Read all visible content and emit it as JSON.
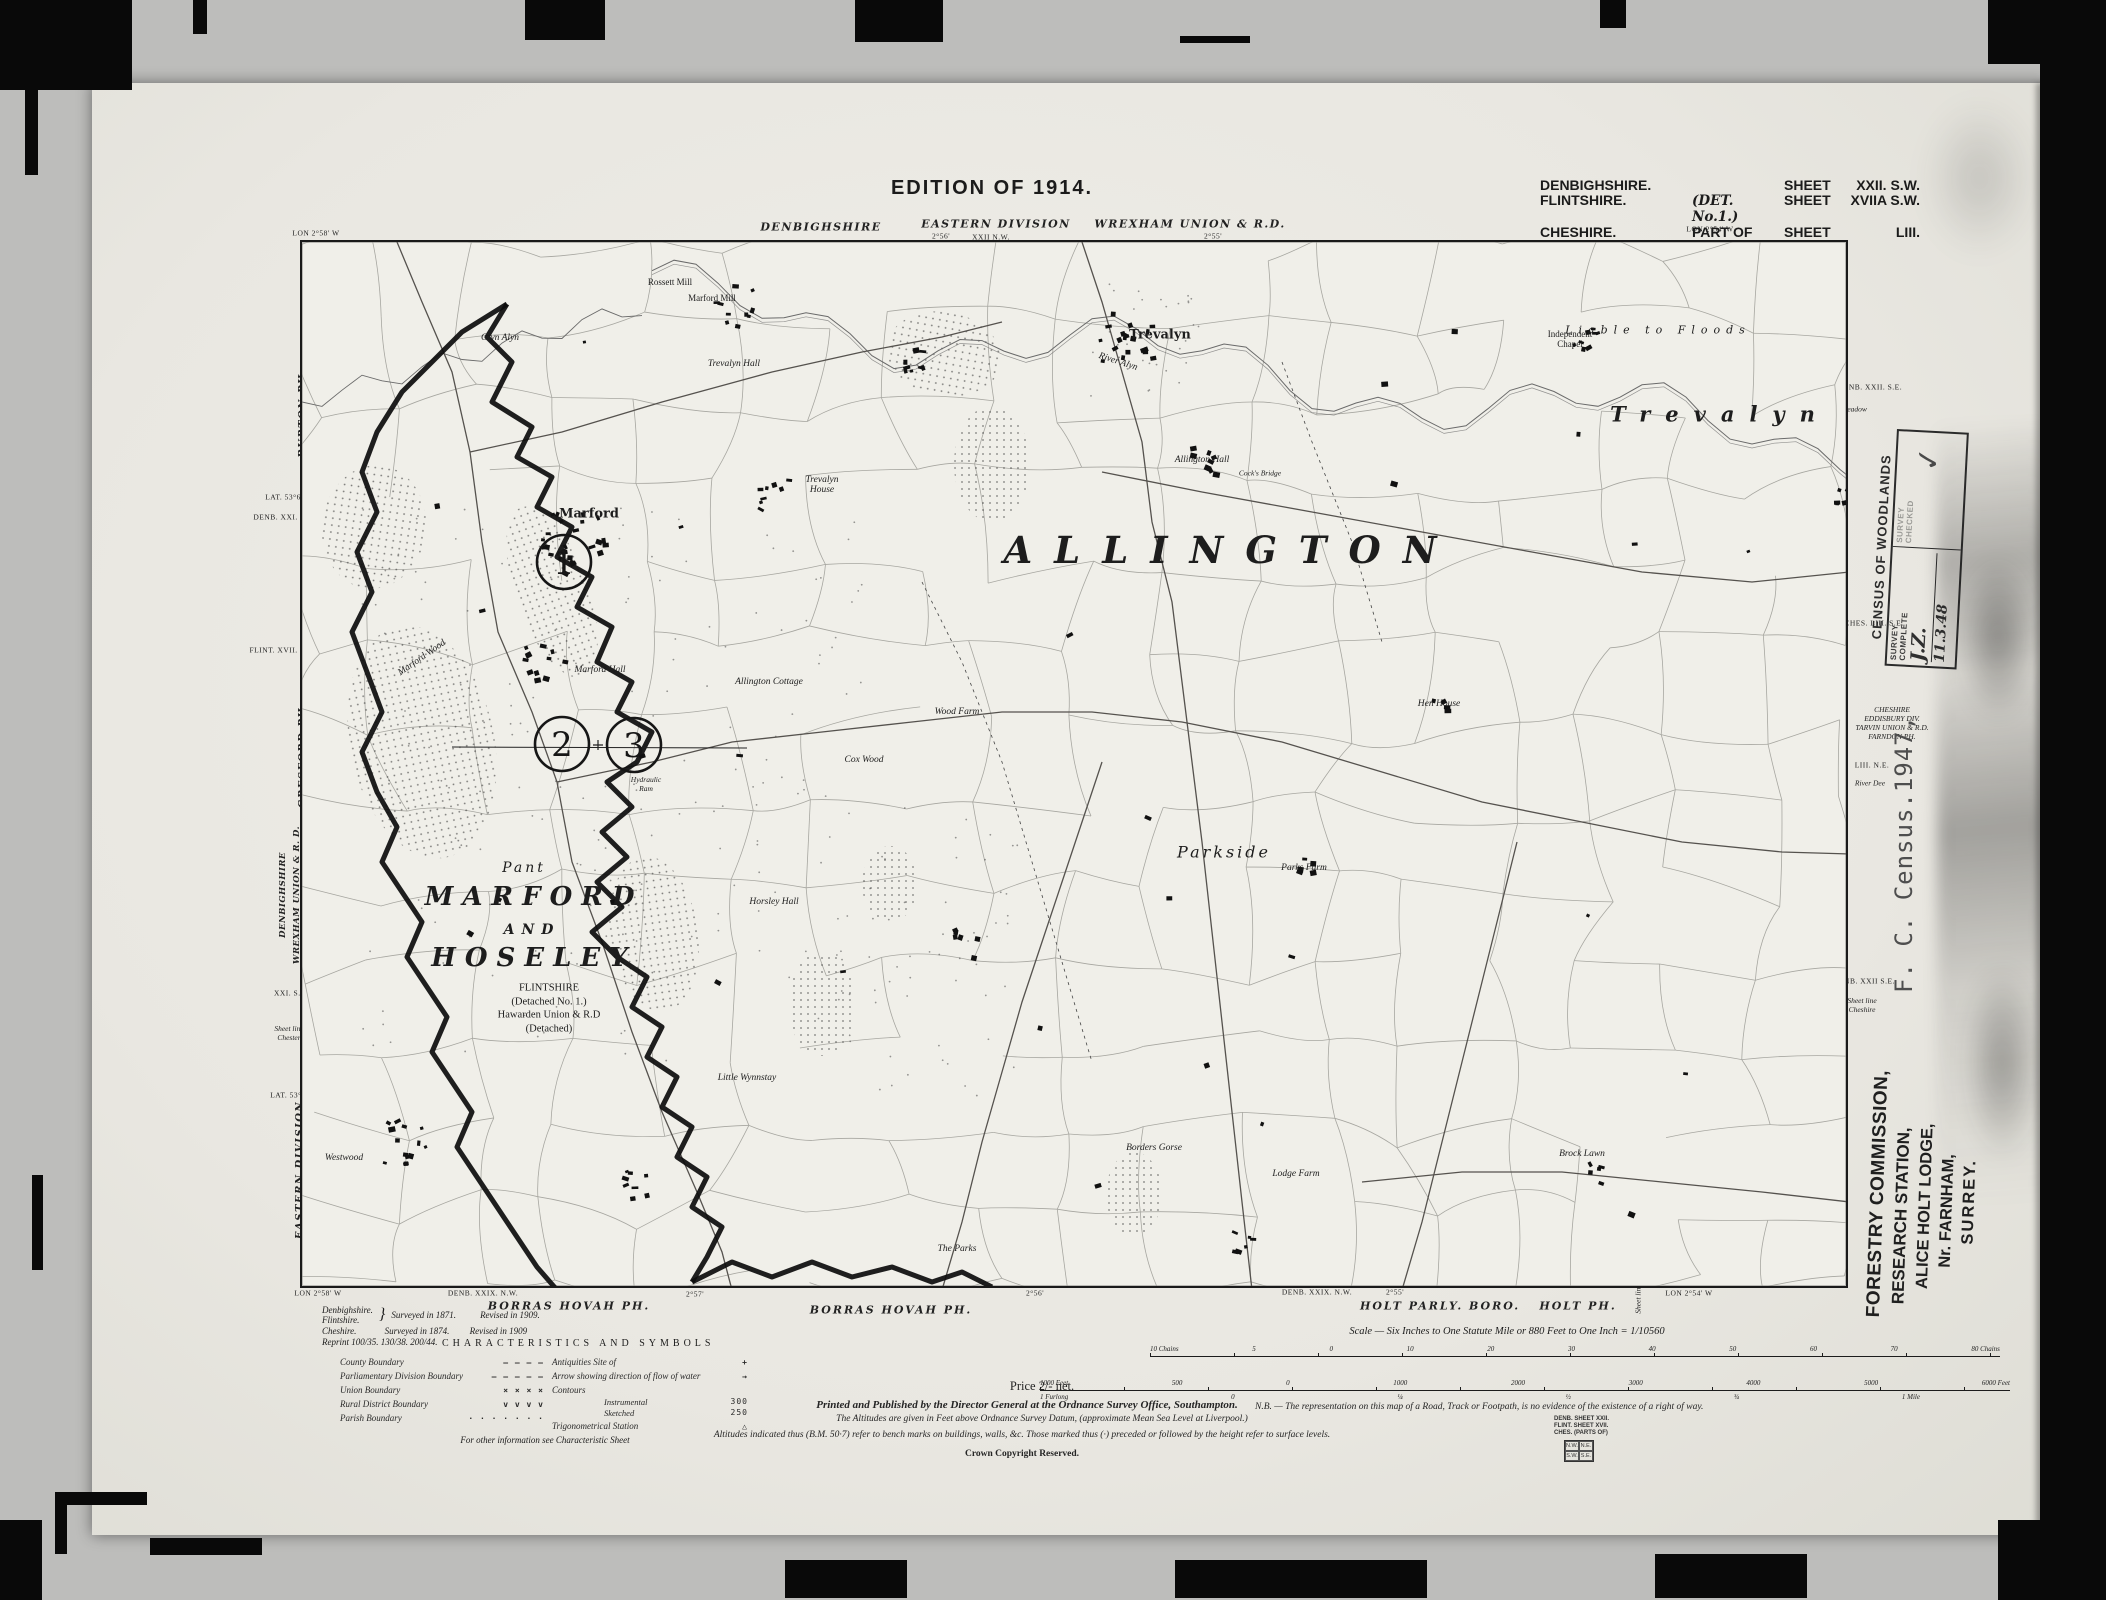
{
  "edition": "EDITION OF 1914.",
  "sheet_info": {
    "rows": [
      {
        "county": "DENBIGHSHIRE.",
        "detail": "",
        "sheet": "SHEET",
        "number": "XXII. S.W."
      },
      {
        "county": "FLINTSHIRE.",
        "detail": "(DET. No.1.)",
        "sheet": "SHEET",
        "number": "XVIIA S.W."
      },
      {
        "county": "CHESHIRE.",
        "detail": "PART OF",
        "sheet": "SHEET",
        "number": "LIII."
      }
    ]
  },
  "top_margin": {
    "items": [
      {
        "text": "LON 2°58' W",
        "x": 224,
        "y": 150,
        "cls": "t6"
      },
      {
        "text": "DENBIGHSHIRE",
        "x": 729,
        "y": 144,
        "cls": "county"
      },
      {
        "text": "EASTERN DIVISION",
        "x": 904,
        "y": 141,
        "cls": "county"
      },
      {
        "text": "2°56'",
        "x": 849,
        "y": 153,
        "cls": "t6"
      },
      {
        "text": "XXII N.W.",
        "x": 899,
        "y": 154,
        "cls": "t6"
      },
      {
        "text": "WREXHAM UNION & R.D.",
        "x": 1098,
        "y": 141,
        "cls": "county"
      },
      {
        "text": "2°55'",
        "x": 1121,
        "y": 153,
        "cls": "t6"
      },
      {
        "text": "LON 2°54' W",
        "x": 1618,
        "y": 146,
        "cls": "t6"
      }
    ]
  },
  "left_margin": {
    "items": [
      {
        "text": "BURTON PH.",
        "x": 211,
        "y": 330,
        "cls": "ph",
        "rot": true
      },
      {
        "text": "LAT. 53°6'",
        "x": 192,
        "y": 414,
        "cls": "t6"
      },
      {
        "text": "DENB. XXI. S.E.",
        "x": 192,
        "y": 434,
        "cls": "t6"
      },
      {
        "text": "FLINT. XVII. S.E.",
        "x": 190,
        "y": 567,
        "cls": "t6"
      },
      {
        "text": "GRESFORD PH.",
        "x": 211,
        "y": 672,
        "cls": "ph",
        "rot": true
      },
      {
        "text": "DENBIGHSHIRE",
        "x": 191,
        "y": 812,
        "cls": "ph2",
        "rot": true
      },
      {
        "text": "WREXHAM UNION & R. D.",
        "x": 205,
        "y": 812,
        "cls": "ph2",
        "rot": true
      },
      {
        "text": "Gresford",
        "x": 216,
        "y": 883,
        "cls": "t6i",
        "rot": true
      },
      {
        "text": "XXI. S.E.",
        "x": 199,
        "y": 910,
        "cls": "t6"
      },
      {
        "text": "Sheet line\nChester",
        "x": 197,
        "y": 950,
        "cls": "t6i"
      },
      {
        "text": "LAT. 53°5'",
        "x": 197,
        "y": 1012,
        "cls": "t6"
      },
      {
        "text": "EASTERN DIVISION",
        "x": 208,
        "y": 1087,
        "cls": "ph",
        "rot": true
      }
    ]
  },
  "right_margin": {
    "items": [
      {
        "text": "DENB. XXII. S.E.",
        "x": 1778,
        "y": 304,
        "cls": "t6"
      },
      {
        "text": "Meadow",
        "x": 1762,
        "y": 326,
        "cls": "t6i"
      },
      {
        "text": "CHES. LIII. S.E.",
        "x": 1782,
        "y": 540,
        "cls": "t6"
      },
      {
        "text": "CHESHIRE\nEDDISBURY DIV.\nTARVIN UNION & R.D.\nFARNDON PH.",
        "x": 1800,
        "y": 640,
        "cls": "t6i"
      },
      {
        "text": "LIII. N.E.",
        "x": 1780,
        "y": 682,
        "cls": "t6"
      },
      {
        "text": "River Dee",
        "x": 1778,
        "y": 700,
        "cls": "t6i"
      },
      {
        "text": "DENB. XXII S.E.",
        "x": 1772,
        "y": 898,
        "cls": "t6"
      },
      {
        "text": "Sheet line\nCheshire",
        "x": 1770,
        "y": 922,
        "cls": "t6i"
      }
    ]
  },
  "bottom_margin": {
    "items": [
      {
        "text": "LON 2°58' W",
        "x": 226,
        "y": 1210,
        "cls": "t6"
      },
      {
        "text": "DENB. XXIX. N.W.",
        "x": 391,
        "y": 1210,
        "cls": "t6"
      },
      {
        "text": "BORRAS HOVAH PH.",
        "x": 477,
        "y": 1223,
        "cls": "phh"
      },
      {
        "text": "2°57'",
        "x": 603,
        "y": 1211,
        "cls": "t6"
      },
      {
        "text": "BORRAS HOVAH PH.",
        "x": 799,
        "y": 1227,
        "cls": "phh"
      },
      {
        "text": "2°56'",
        "x": 943,
        "y": 1210,
        "cls": "t6"
      },
      {
        "text": "DENB. XXIX. N.W.",
        "x": 1225,
        "y": 1209,
        "cls": "t6"
      },
      {
        "text": "2°55'",
        "x": 1303,
        "y": 1209,
        "cls": "t6"
      },
      {
        "text": "HOLT PARLY. BORO.",
        "x": 1348,
        "y": 1223,
        "cls": "phh"
      },
      {
        "text": "HOLT PH.",
        "x": 1486,
        "y": 1223,
        "cls": "phh"
      },
      {
        "text": "Sheet line",
        "x": 1546,
        "y": 1216,
        "cls": "t6i",
        "rot": true
      },
      {
        "text": "LON 2°54' W",
        "x": 1597,
        "y": 1210,
        "cls": "t6"
      }
    ]
  },
  "survey_notes": {
    "brace_counties": "Denbighshire.\nFlintshire.",
    "brace": "}",
    "brace_surveyed": "Surveyed in 1871.",
    "brace_revised": "Revised in 1909.",
    "line2_county": "Cheshire.",
    "line2_surveyed": "Surveyed in 1874.",
    "line2_revised": "Revised in 1909",
    "reprint": "Reprint 100/35. 130/38. 200/44."
  },
  "legend": {
    "title": "CHARACTERISTICS AND SYMBOLS",
    "left": [
      {
        "label": "County Boundary",
        "glyph": "— — — —"
      },
      {
        "label": "Parliamentary Division Boundary",
        "glyph": "– – – – –"
      },
      {
        "label": "Union Boundary",
        "glyph": "×  ×  ×  ×"
      },
      {
        "label": "Rural District Boundary",
        "glyph": "v  v  v  v"
      },
      {
        "label": "Parish Boundary",
        "glyph": "· · · · · · ·"
      }
    ],
    "right": [
      {
        "label": "Antiquities  Site of",
        "glyph": "+"
      },
      {
        "label": "Arrow showing direction of flow of water",
        "glyph": "→"
      },
      {
        "label": "Contours",
        "sub": [
          {
            "label": "Instrumental",
            "glyph": "300"
          },
          {
            "label": "Sketched",
            "glyph": "250"
          }
        ]
      },
      {
        "label": "Trigonometrical Station",
        "glyph": "△"
      }
    ],
    "footnote": "For other information see Characteristic Sheet"
  },
  "scale_block": {
    "title": "Scale — Six Inches to One Statute Mile or 880 Feet to One Inch = 1/10560",
    "chains_labels": [
      "10 Chains",
      "5",
      "0",
      "10",
      "20",
      "30",
      "40",
      "50",
      "60",
      "70",
      "80 Chains"
    ],
    "feet_labels": [
      "1000 Feet",
      "500",
      "0",
      "1000",
      "2000",
      "3000",
      "4000",
      "5000",
      "6000 Feet"
    ],
    "mile_labels": [
      "1 Furlong",
      "0",
      "¼",
      "½",
      "¾",
      "1 Mile"
    ]
  },
  "footer": {
    "price": "Price 2/- net.",
    "publisher": "Printed and Published by the Director General at the Ordnance Survey Office, Southampton.",
    "nb": "N.B. — The representation on this map of a Road, Track or Footpath, is no evidence of the existence of a right of way.",
    "altitude1": "The Altitudes are given in Feet above Ordnance Survey Datum, (approximate Mean Sea Level at Liverpool.)",
    "altitude2": "Altitudes indicated thus (B.M. 50·7) refer to bench marks on buildings, walls, &c. Those marked thus (·) preceded or followed by the height refer to surface levels.",
    "copyright": "Crown Copyright Reserved.",
    "index_lines": "DENB. SHEET XXII.\nFLINT. SHEET XVII.\nCHES. (PARTS OF)",
    "index_grid": [
      "N.W.",
      "N.E.",
      "S.W.",
      "S.E."
    ]
  },
  "stamps": {
    "census_title": "CENSUS OF WOODLANDS",
    "census_cells": {
      "c1_label": "SURVEY\nCOMPLETE",
      "c1_hand": "J.Z.",
      "c1_date": "11.3.48",
      "c2_label": "SURVEY\nCHECKED",
      "c2_mark": "✓"
    },
    "census_ref": "F. C. Census.1947,",
    "forestry": [
      "FORESTRY COMMISSION,",
      "RESEARCH STATION,",
      "ALICE HOLT LODGE,",
      "Nr. FARNHAM,",
      "SURREY."
    ]
  },
  "map": {
    "circles": [
      {
        "n": "1",
        "x": 262,
        "y": 320
      },
      {
        "n": "2",
        "x": 260,
        "y": 502
      },
      {
        "n": "3",
        "x": 332,
        "y": 503
      }
    ],
    "labels": [
      {
        "text": "ALLINGTON",
        "x": 929,
        "y": 308,
        "cls": "lh"
      },
      {
        "text": "MARFORD",
        "x": 232,
        "y": 655,
        "cls": "lb"
      },
      {
        "text": "AND",
        "x": 230,
        "y": 688,
        "cls": "lmsp"
      },
      {
        "text": "HOSELEY",
        "x": 232,
        "y": 716,
        "cls": "lb"
      },
      {
        "text": "Trevalyn",
        "x": 1418,
        "y": 172,
        "cls": "llg"
      },
      {
        "text": "Liable to Floods",
        "x": 1356,
        "y": 88,
        "cls": "lsp"
      },
      {
        "text": "Parkside",
        "x": 922,
        "y": 610,
        "cls": "lmd"
      },
      {
        "text": "Pant",
        "x": 222,
        "y": 626,
        "cls": "lmd2"
      },
      {
        "text": "Trevalyn",
        "x": 858,
        "y": 93,
        "cls": "lbold"
      },
      {
        "text": "Marford",
        "x": 287,
        "y": 272,
        "cls": "lbold"
      },
      {
        "text": "FLINTSHIRE\n(Detached No. 1.)\nHawarden Union & R.D\n(Detached)",
        "x": 247,
        "y": 767,
        "cls": "lnote"
      },
      {
        "text": "Trevalyn\nHouse",
        "x": 520,
        "y": 243,
        "cls": "lsmi"
      },
      {
        "text": "Allington Hall",
        "x": 900,
        "y": 218,
        "cls": "lsmi"
      },
      {
        "text": "Independent\nChapel",
        "x": 1268,
        "y": 97,
        "cls": "lsm"
      },
      {
        "text": "Allington Cottage",
        "x": 467,
        "y": 440,
        "cls": "lsmi"
      },
      {
        "text": "Horsley Hall",
        "x": 472,
        "y": 660,
        "cls": "lsmi"
      },
      {
        "text": "Little Wynnstay",
        "x": 445,
        "y": 836,
        "cls": "lsmi"
      },
      {
        "text": "Borders Gorse",
        "x": 852,
        "y": 906,
        "cls": "lsmi"
      },
      {
        "text": "Lodge Farm",
        "x": 994,
        "y": 932,
        "cls": "lsmi"
      },
      {
        "text": "The Parks",
        "x": 655,
        "y": 1007,
        "cls": "lsmi"
      },
      {
        "text": "Brock Lawn",
        "x": 1280,
        "y": 912,
        "cls": "lsmi"
      },
      {
        "text": "Parks Farm",
        "x": 1002,
        "y": 626,
        "cls": "lsmi"
      },
      {
        "text": "Wood Farm",
        "x": 655,
        "y": 470,
        "cls": "lsmi"
      },
      {
        "text": "Cox Wood",
        "x": 562,
        "y": 518,
        "cls": "lsmi"
      },
      {
        "text": "Marford Hall",
        "x": 298,
        "y": 428,
        "cls": "lsmi"
      },
      {
        "text": "Marford Mill",
        "x": 410,
        "y": 56,
        "cls": "lsm"
      },
      {
        "text": "Rossett Mill",
        "x": 368,
        "y": 40,
        "cls": "lsm"
      },
      {
        "text": "Glyn Alyn",
        "x": 198,
        "y": 96,
        "cls": "lsmi"
      },
      {
        "text": "Trevalyn Hall",
        "x": 432,
        "y": 122,
        "cls": "lsmi"
      },
      {
        "text": "Marford Wood",
        "x": 120,
        "y": 416,
        "cls": "lsmi",
        "rot": -35
      },
      {
        "text": "Westwood",
        "x": 42,
        "y": 916,
        "cls": "lsmi"
      },
      {
        "text": "River Alyn",
        "x": 816,
        "y": 120,
        "cls": "lsmi",
        "rot": 18
      },
      {
        "text": "Hydraulic\nRam",
        "x": 344,
        "y": 542,
        "cls": "ltiny"
      },
      {
        "text": "Cock's Bridge",
        "x": 958,
        "y": 231,
        "cls": "ltiny"
      },
      {
        "text": "Hen House",
        "x": 1137,
        "y": 462,
        "cls": "lsmi"
      }
    ]
  },
  "colors": {
    "paper": "#f0efe9",
    "ink": "#1b1b1b",
    "field_line": "#95958f",
    "bg": "#bdbdbb"
  }
}
